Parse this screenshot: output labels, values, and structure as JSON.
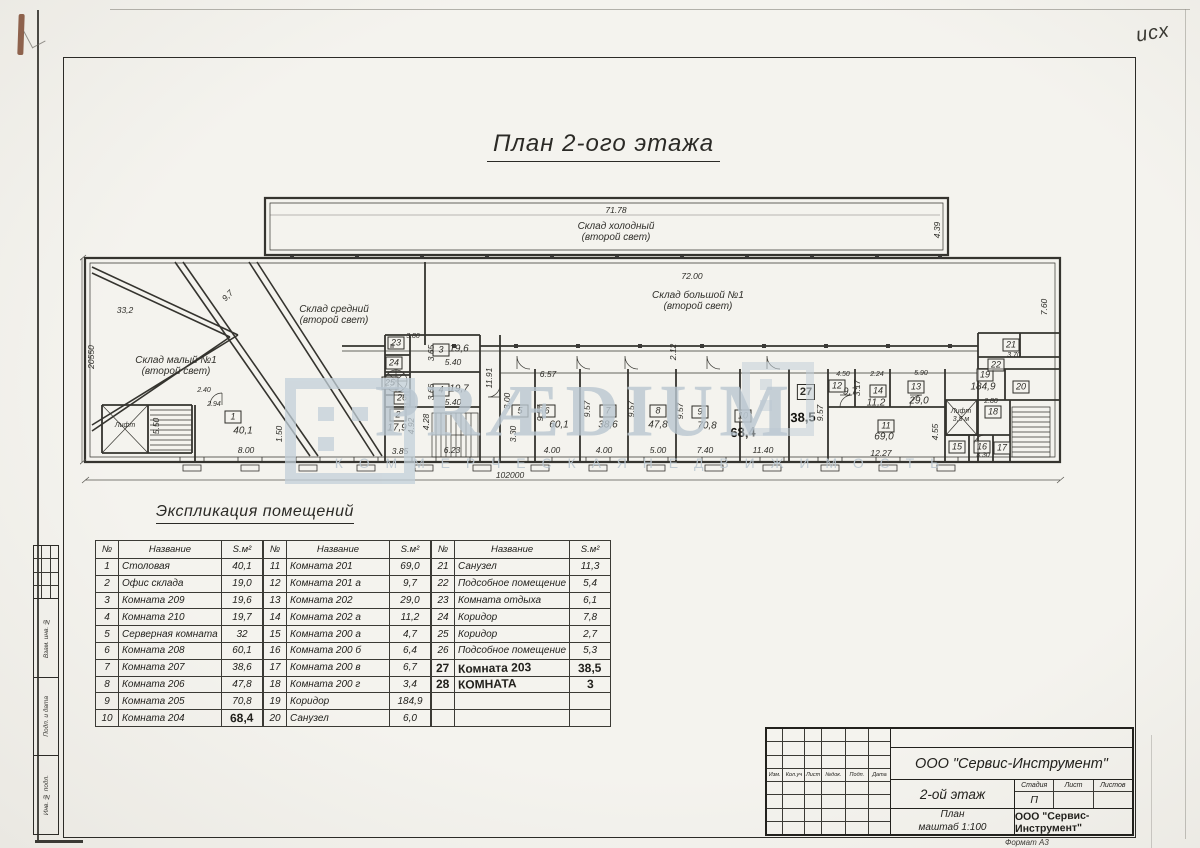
{
  "meta": {
    "corner_note": "исх"
  },
  "sheet": {
    "title": "План 2-ого этажа",
    "format_note": "Формат А3"
  },
  "watermark": {
    "text": "PRÆDIUM",
    "subtext": "К О М М Е Р Ч Е С К А Я   Н Е Д В И Ж И М О С Т Ь",
    "color": "#bac7d1"
  },
  "plan": {
    "labels": [
      {
        "t": "Склад холодный\n(второй свет)",
        "x": 536,
        "y": 47,
        "c": "n"
      },
      {
        "t": "Склад большой №1\n(второй свет)",
        "x": 618,
        "y": 116,
        "c": "n"
      },
      {
        "t": "Склад средний\n(второй свет)",
        "x": 254,
        "y": 130,
        "c": "n"
      },
      {
        "t": "Склад малый №1\n(второй свет)",
        "x": 96,
        "y": 181,
        "c": "n"
      },
      {
        "t": "Лифт",
        "x": 45,
        "y": 241,
        "c": "s"
      },
      {
        "t": "Лифт\n3,5 м",
        "x": 881,
        "y": 231,
        "c": "s"
      },
      {
        "t": "71.78",
        "x": 536,
        "y": 26,
        "c": "d"
      },
      {
        "t": "72.00",
        "x": 612,
        "y": 92,
        "c": "d"
      },
      {
        "t": "33,2",
        "x": 45,
        "y": 126,
        "c": "d"
      },
      {
        "t": "9,7",
        "x": 148,
        "y": 111,
        "c": "d",
        "r": -46
      },
      {
        "t": "8.00",
        "x": 166,
        "y": 266,
        "c": "d"
      },
      {
        "t": "2.40",
        "x": 124,
        "y": 206,
        "c": "s"
      },
      {
        "t": "2.94",
        "x": 134,
        "y": 220,
        "c": "s"
      },
      {
        "t": "3.85",
        "x": 320,
        "y": 267,
        "c": "d"
      },
      {
        "t": "6.23",
        "x": 372,
        "y": 266,
        "c": "d"
      },
      {
        "t": "5.40",
        "x": 373,
        "y": 178,
        "c": "d"
      },
      {
        "t": "5.40",
        "x": 373,
        "y": 218,
        "c": "d"
      },
      {
        "t": "3.80",
        "x": 333,
        "y": 152,
        "c": "s"
      },
      {
        "t": "6.57",
        "x": 468,
        "y": 190,
        "c": "d"
      },
      {
        "t": "4.00",
        "x": 472,
        "y": 266,
        "c": "d"
      },
      {
        "t": "4.00",
        "x": 524,
        "y": 266,
        "c": "d"
      },
      {
        "t": "5.00",
        "x": 578,
        "y": 266,
        "c": "d"
      },
      {
        "t": "7.40",
        "x": 625,
        "y": 266,
        "c": "d"
      },
      {
        "t": "11.40",
        "x": 683,
        "y": 266,
        "c": "d"
      },
      {
        "t": "12.27",
        "x": 801,
        "y": 269,
        "c": "d"
      },
      {
        "t": "4.50",
        "x": 763,
        "y": 190,
        "c": "s"
      },
      {
        "t": "2.24",
        "x": 797,
        "y": 190,
        "c": "s"
      },
      {
        "t": "5.90",
        "x": 841,
        "y": 189,
        "c": "s"
      },
      {
        "t": "3.70",
        "x": 934,
        "y": 171,
        "c": "s"
      },
      {
        "t": "2.80",
        "x": 911,
        "y": 217,
        "c": "s"
      },
      {
        "t": "3.30",
        "x": 903,
        "y": 271,
        "c": "s"
      },
      {
        "t": "102000",
        "x": 430,
        "y": 291,
        "c": "d"
      },
      {
        "t": "40,1",
        "x": 163,
        "y": 246,
        "c": "a"
      },
      {
        "t": "17,9",
        "x": 317,
        "y": 243,
        "c": "a"
      },
      {
        "t": "19,6",
        "x": 379,
        "y": 164,
        "c": "a"
      },
      {
        "t": "19,7",
        "x": 379,
        "y": 204,
        "c": "a"
      },
      {
        "t": "60,1",
        "x": 479,
        "y": 240,
        "c": "a"
      },
      {
        "t": "38,6",
        "x": 528,
        "y": 240,
        "c": "a"
      },
      {
        "t": "47,8",
        "x": 578,
        "y": 240,
        "c": "a"
      },
      {
        "t": "70,8",
        "x": 627,
        "y": 241,
        "c": "a"
      },
      {
        "t": "9,7",
        "x": 770,
        "y": 207,
        "c": "a"
      },
      {
        "t": "11,2",
        "x": 796,
        "y": 218,
        "c": "a"
      },
      {
        "t": "29,0",
        "x": 839,
        "y": 216,
        "c": "a"
      },
      {
        "t": "69,0",
        "x": 804,
        "y": 252,
        "c": "a"
      },
      {
        "t": "184,9",
        "x": 903,
        "y": 202,
        "c": "a"
      },
      {
        "t": "68,4",
        "x": 663,
        "y": 248,
        "c": "h"
      },
      {
        "t": "38,5",
        "x": 723,
        "y": 233,
        "c": "h"
      },
      {
        "t": "20550",
        "x": 12,
        "y": 172,
        "c": "v",
        "r": -90
      },
      {
        "t": "4.39",
        "x": 858,
        "y": 45,
        "c": "v",
        "r": -90
      },
      {
        "t": "7.60",
        "x": 965,
        "y": 122,
        "c": "v",
        "r": -90
      },
      {
        "t": "11.91",
        "x": 410,
        "y": 193,
        "c": "v",
        "r": -90
      },
      {
        "t": "5.50",
        "x": 77,
        "y": 241,
        "c": "v",
        "r": -90
      },
      {
        "t": "1.50",
        "x": 200,
        "y": 249,
        "c": "v",
        "r": -90
      },
      {
        "t": "4.92",
        "x": 332,
        "y": 241,
        "c": "v",
        "r": -90
      },
      {
        "t": "4.28",
        "x": 347,
        "y": 237,
        "c": "v",
        "r": -90
      },
      {
        "t": "3.65",
        "x": 352,
        "y": 168,
        "c": "v",
        "r": -90
      },
      {
        "t": "3.66",
        "x": 352,
        "y": 207,
        "c": "v",
        "r": -90
      },
      {
        "t": "3.00",
        "x": 428,
        "y": 216,
        "c": "v",
        "r": -90
      },
      {
        "t": "3.30",
        "x": 434,
        "y": 249,
        "c": "v",
        "r": -90
      },
      {
        "t": "9.57",
        "x": 461,
        "y": 228,
        "c": "v",
        "r": -90
      },
      {
        "t": "9.57",
        "x": 508,
        "y": 224,
        "c": "v",
        "r": -90
      },
      {
        "t": "9.57",
        "x": 552,
        "y": 224,
        "c": "v",
        "r": -90
      },
      {
        "t": "9.57",
        "x": 601,
        "y": 226,
        "c": "v",
        "r": -90
      },
      {
        "t": "9.57",
        "x": 741,
        "y": 228,
        "c": "v",
        "r": -90
      },
      {
        "t": "2.12",
        "x": 594,
        "y": 167,
        "c": "v",
        "r": -90
      },
      {
        "t": "3.17",
        "x": 778,
        "y": 203,
        "c": "v",
        "r": -90
      },
      {
        "t": "4.55",
        "x": 856,
        "y": 247,
        "c": "v",
        "r": -90
      }
    ],
    "room_boxes": [
      {
        "n": "1",
        "x": 153,
        "y": 232
      },
      {
        "n": "2",
        "x": 318,
        "y": 230
      },
      {
        "n": "3",
        "x": 361,
        "y": 165
      },
      {
        "n": "4",
        "x": 361,
        "y": 205
      },
      {
        "n": "5",
        "x": 440,
        "y": 226
      },
      {
        "n": "6",
        "x": 467,
        "y": 226
      },
      {
        "n": "7",
        "x": 528,
        "y": 226
      },
      {
        "n": "8",
        "x": 578,
        "y": 226
      },
      {
        "n": "9",
        "x": 620,
        "y": 227
      },
      {
        "n": "10",
        "x": 663,
        "y": 231
      },
      {
        "n": "11",
        "x": 806,
        "y": 241
      },
      {
        "n": "12",
        "x": 757,
        "y": 201
      },
      {
        "n": "13",
        "x": 836,
        "y": 202
      },
      {
        "n": "14",
        "x": 798,
        "y": 206
      },
      {
        "n": "15",
        "x": 877,
        "y": 262
      },
      {
        "n": "16",
        "x": 902,
        "y": 262
      },
      {
        "n": "17",
        "x": 922,
        "y": 263
      },
      {
        "n": "18",
        "x": 913,
        "y": 227
      },
      {
        "n": "19",
        "x": 905,
        "y": 190
      },
      {
        "n": "20",
        "x": 941,
        "y": 202
      },
      {
        "n": "21",
        "x": 931,
        "y": 160
      },
      {
        "n": "22",
        "x": 916,
        "y": 180
      },
      {
        "n": "23",
        "x": 316,
        "y": 158
      },
      {
        "n": "24",
        "x": 314,
        "y": 178
      },
      {
        "n": "25",
        "x": 310,
        "y": 198
      },
      {
        "n": "26",
        "x": 322,
        "y": 213
      },
      {
        "n": "27",
        "x": 726,
        "y": 207,
        "hand": true
      }
    ]
  },
  "explication": {
    "heading": "Экспликация помещений",
    "headers": {
      "num": "№",
      "name": "Название",
      "area": "S.м²"
    },
    "groups": [
      {
        "rows": [
          [
            "1",
            "Столовая",
            "40,1"
          ],
          [
            "2",
            "Офис склада",
            "19,0"
          ],
          [
            "3",
            "Комната 209",
            "19,6"
          ],
          [
            "4",
            "Комната 210",
            "19,7"
          ],
          [
            "5",
            "Серверная комната",
            "32"
          ],
          [
            "6",
            "Комната 208",
            "60,1"
          ],
          [
            "7",
            "Комната 207",
            "38,6"
          ],
          [
            "8",
            "Комната 206",
            "47,8"
          ],
          [
            "9",
            "Комната 205",
            "70,8"
          ],
          [
            "10",
            "Комната 204",
            "68,4"
          ]
        ],
        "hand_cells": [
          [
            9,
            2
          ]
        ]
      },
      {
        "rows": [
          [
            "11",
            "Комната 201",
            "69,0"
          ],
          [
            "12",
            "Комната 201 а",
            "9,7"
          ],
          [
            "13",
            "Комната 202",
            "29,0"
          ],
          [
            "14",
            "Комната 202 а",
            "11,2"
          ],
          [
            "15",
            "Комната 200 а",
            "4,7"
          ],
          [
            "16",
            "Комната 200 б",
            "6,4"
          ],
          [
            "17",
            "Комната 200 в",
            "6,7"
          ],
          [
            "18",
            "Комната 200 г",
            "3,4"
          ],
          [
            "19",
            "Коридор",
            "184,9"
          ],
          [
            "20",
            "Санузел",
            "6,0"
          ]
        ],
        "hand_cells": []
      },
      {
        "rows": [
          [
            "21",
            "Санузел",
            "11,3"
          ],
          [
            "22",
            "Подсобное помещение",
            "5,4"
          ],
          [
            "23",
            "Комната отдыха",
            "6,1"
          ],
          [
            "24",
            "Коридор",
            "7,8"
          ],
          [
            "25",
            "Коридор",
            "2,7"
          ],
          [
            "26",
            "Подсобное помещение",
            "5,3"
          ],
          [
            "27",
            "Комната 203",
            "38,5"
          ],
          [
            "28",
            "КОМНАТА",
            "3"
          ],
          [
            "",
            "",
            ""
          ],
          [
            "",
            "",
            ""
          ]
        ],
        "hand_cells": [],
        "hand_rows": [
          6,
          7
        ]
      }
    ]
  },
  "titleblock": {
    "company": "ООО \"Сервис-Инструмент\"",
    "object": "2-ой этаж",
    "sheet_name": "План\nмаштаб 1:100",
    "org_handwritten": "ООО \"Сервис-Инструмент\"",
    "stage_headers": [
      "Стадия",
      "Лист",
      "Листов"
    ],
    "stage_value": "П",
    "rev_headers": [
      "Изм.",
      "Кол.уч",
      "Лист",
      "№док.",
      "Подп.",
      "Дата"
    ]
  },
  "side_stamp": {
    "approved": "Согласовано",
    "labels": [
      "Взам. инв. №",
      "Подп. и дата",
      "Инв. № подл."
    ]
  }
}
